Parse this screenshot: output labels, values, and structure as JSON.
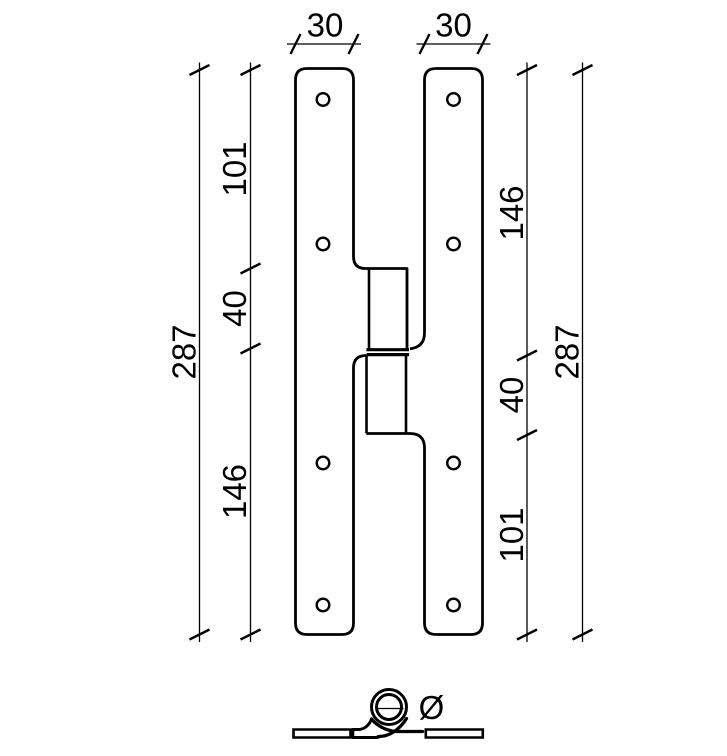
{
  "colors": {
    "line": "#000000",
    "background": "#ffffff"
  },
  "front_view": {
    "plate_width_left": "30",
    "plate_width_right": "30",
    "left_dim_top": "101",
    "left_dim_middle": "40",
    "left_dim_bottom": "146",
    "left_dim_overall": "287",
    "right_dim_top": "146",
    "right_dim_middle": "40",
    "right_dim_bottom": "101",
    "right_dim_overall": "287"
  },
  "top_view": {
    "pin_diameter_symbol": "Ø"
  }
}
